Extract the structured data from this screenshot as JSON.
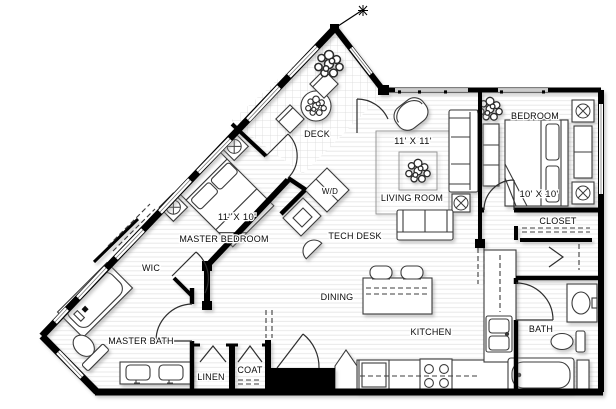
{
  "canvas": {
    "width": 616,
    "height": 409,
    "background": "#ffffff"
  },
  "colors": {
    "wall": "#000000",
    "text": "#0a0a0a",
    "floor_line": "#e9e9e9",
    "deck_grid": "#dadada",
    "furniture_outline": "#3a3a3a",
    "window_frame": "#777777",
    "dash_line": "#3c3c3c"
  },
  "rooms": [
    {
      "id": "deck",
      "label": "DECK"
    },
    {
      "id": "living-room",
      "label": "LIVING ROOM",
      "dim": "11' X 11'"
    },
    {
      "id": "bedroom",
      "label": "BEDROOM",
      "dim": "10' X 10'"
    },
    {
      "id": "closet",
      "label": "CLOSET"
    },
    {
      "id": "master-bedroom",
      "label": "MASTER BEDROOM",
      "dim": "11' X 10'"
    },
    {
      "id": "wic",
      "label": "WIC"
    },
    {
      "id": "tech-desk",
      "label": "TECH DESK"
    },
    {
      "id": "dining",
      "label": "DINING"
    },
    {
      "id": "kitchen",
      "label": "KITCHEN"
    },
    {
      "id": "master-bath",
      "label": "MASTER BATH"
    },
    {
      "id": "bath",
      "label": "BATH"
    },
    {
      "id": "linen",
      "label": "LINEN"
    },
    {
      "id": "coat",
      "label": "COAT"
    },
    {
      "id": "laundry",
      "label": "W/D"
    }
  ],
  "fixtures": [
    "bed",
    "nightstand-lamp",
    "dresser",
    "sofa",
    "armchair",
    "side-table-lamp",
    "area-rug",
    "plant",
    "round-patio-table",
    "patio-chair",
    "desk",
    "desk-chair",
    "kitchen-island-with-stools",
    "range",
    "refrigerator",
    "corner-cabinet",
    "kitchen-sink",
    "bathtub",
    "shower-tub",
    "toilet",
    "vanity-sink",
    "double-vanity",
    "closet-rod",
    "entry-door",
    "window-band"
  ]
}
